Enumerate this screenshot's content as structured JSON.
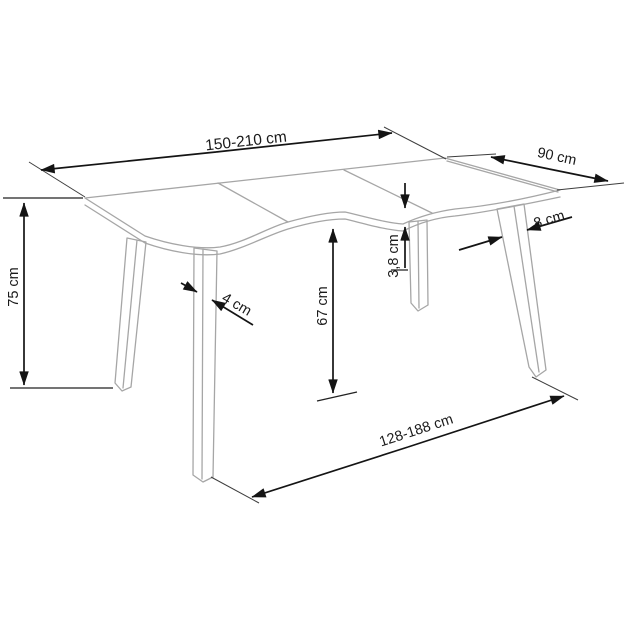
{
  "diagram": {
    "kind": "furniture-dimension-drawing",
    "unit": "cm",
    "colors": {
      "background": "#ffffff",
      "dimension_lines": "#141414",
      "furniture_lines": "#a6a6a6",
      "text": "#1a1a1a"
    },
    "dimensions": {
      "table_length": "150-210 cm",
      "table_depth": "90 cm",
      "table_height": "75 cm",
      "front_leg_thickness": "4 cm",
      "clearance_under_top": "67 cm",
      "top_thickness": "3,8 cm",
      "back_leg_width": "8 cm",
      "leg_span": "128-188 cm"
    }
  }
}
